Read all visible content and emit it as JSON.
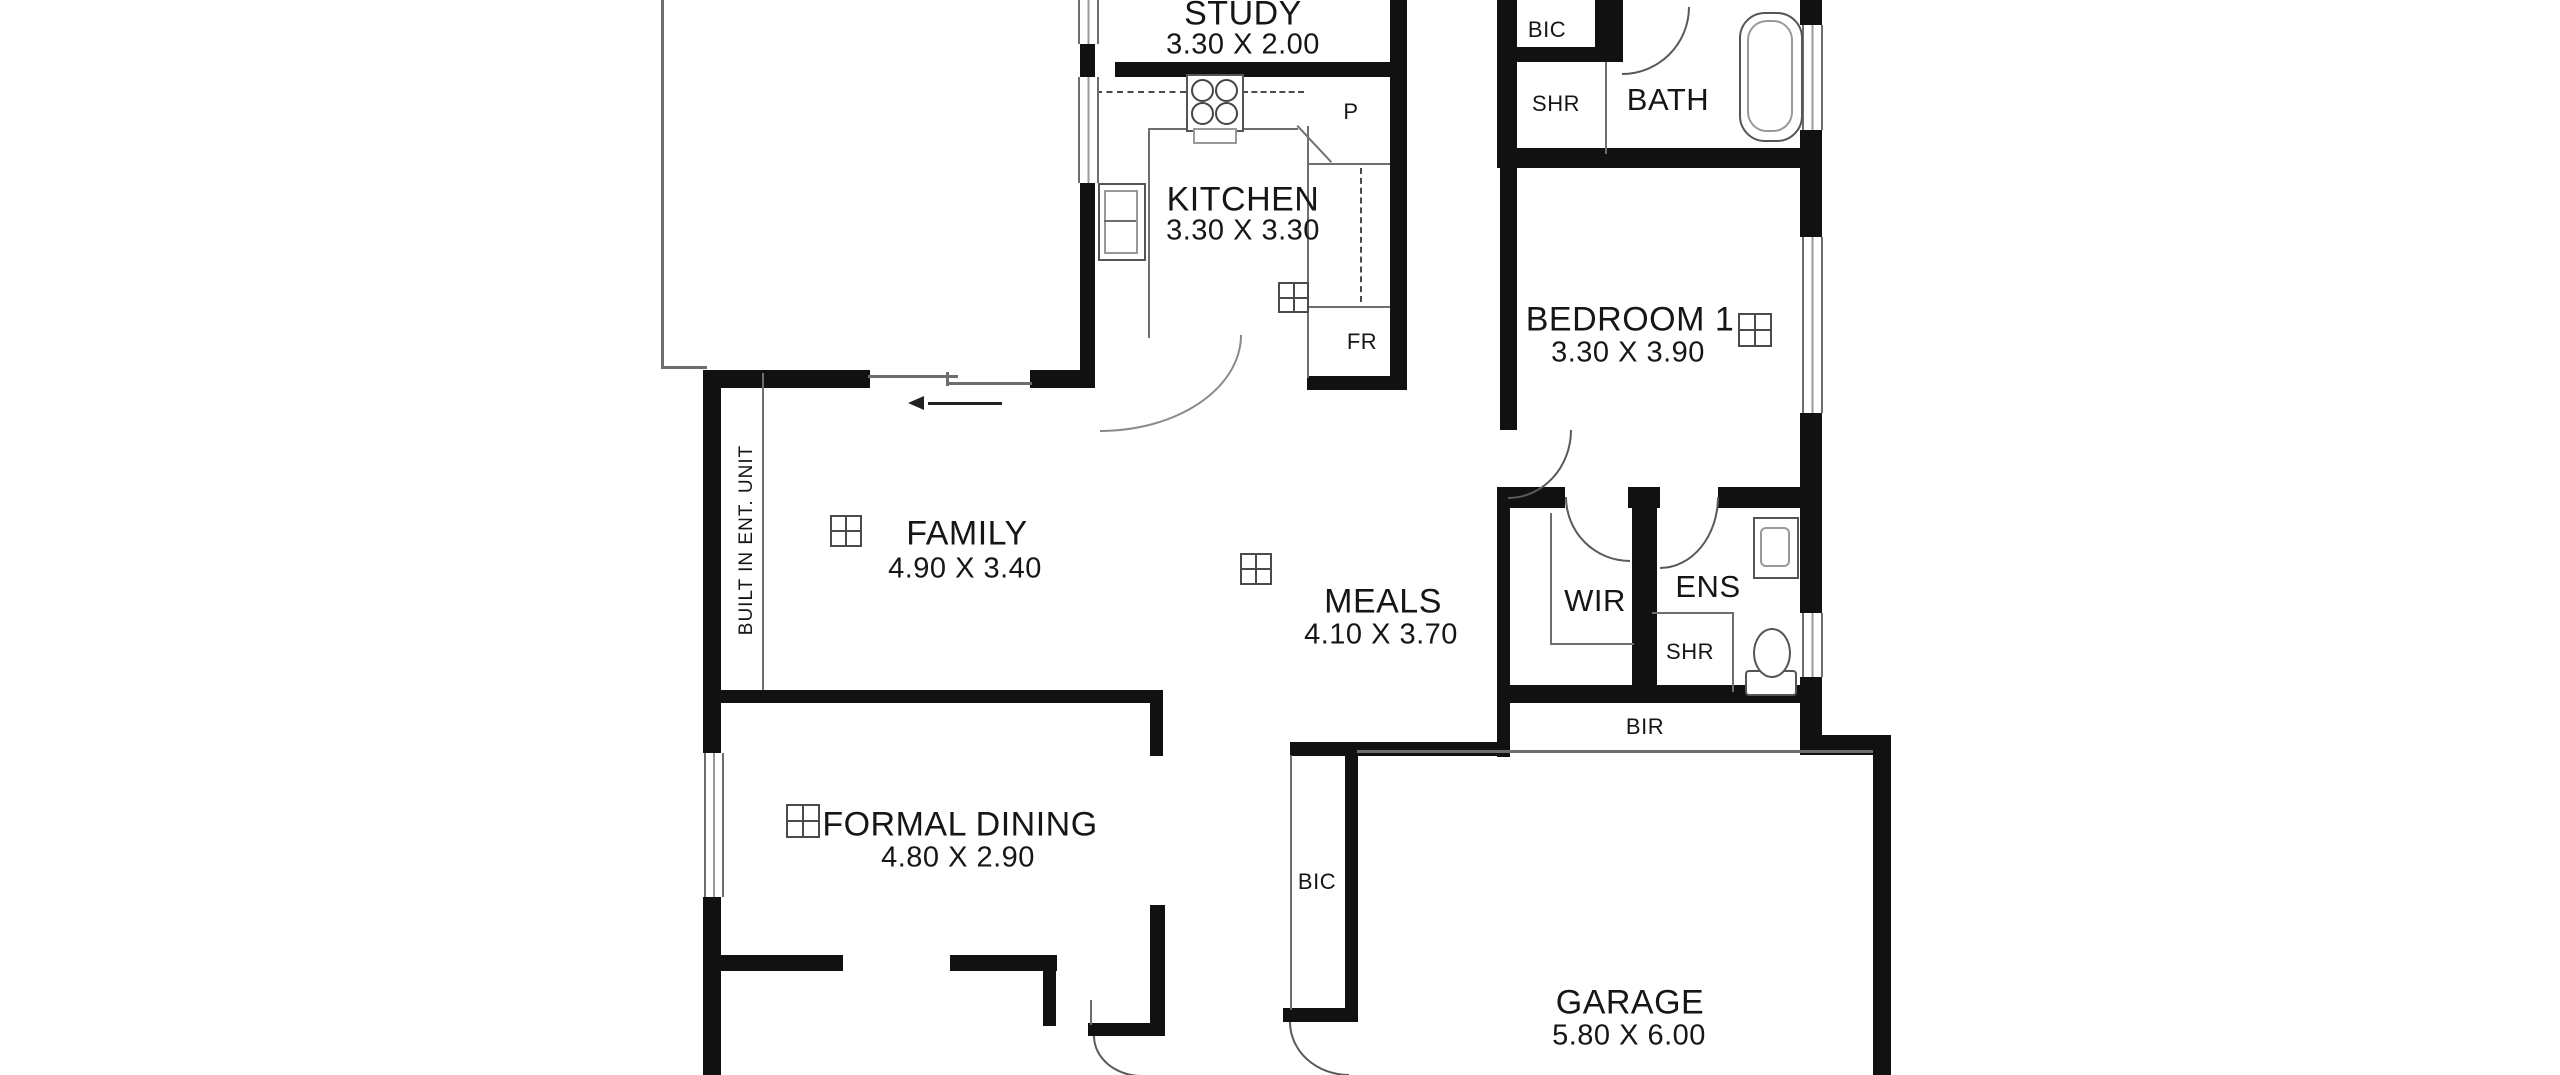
{
  "rooms": {
    "study": {
      "name": "STUDY",
      "dims": "3.30 X 2.00"
    },
    "kitchen": {
      "name": "KITCHEN",
      "dims": "3.30 X 3.30"
    },
    "bath": {
      "name": "BATH"
    },
    "bedroom1": {
      "name": "BEDROOM 1",
      "dims": "3.30 X 3.90"
    },
    "family": {
      "name": "FAMILY",
      "dims": "4.90 X 3.40"
    },
    "meals": {
      "name": "MEALS",
      "dims": "4.10 X 3.70"
    },
    "wir": {
      "name": "WIR"
    },
    "ens": {
      "name": "ENS"
    },
    "formal_dining": {
      "name": "FORMAL DINING",
      "dims": "4.80 X 2.90"
    },
    "garage": {
      "name": "GARAGE",
      "dims": "5.80 X 6.00"
    }
  },
  "labels": {
    "bic_bath": "BIC",
    "shr_bath": "SHR",
    "pantry": "P",
    "fridge": "FR",
    "shr_ens": "SHR",
    "bir": "BIR",
    "bic_entry": "BIC",
    "built_in_ent_unit": "BUILT IN ENT. UNIT"
  },
  "colors": {
    "wall": "#111111",
    "thin_line": "#6e6e6e",
    "text": "#161616",
    "background": "#ffffff"
  }
}
